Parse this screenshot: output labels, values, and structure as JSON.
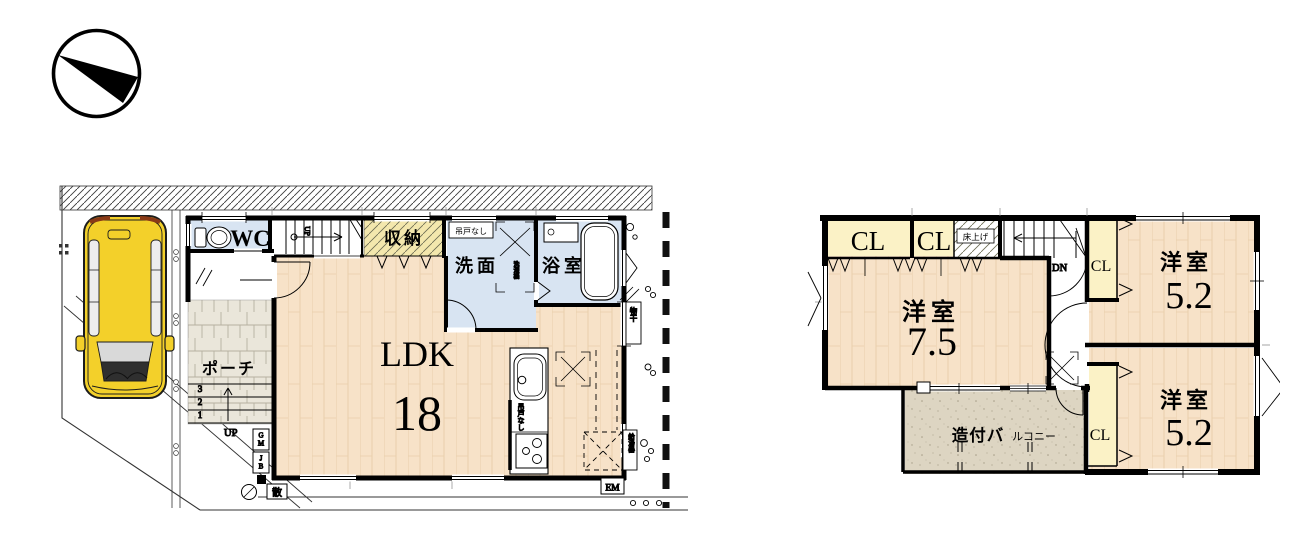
{
  "floor1": {
    "wc": "WC",
    "storage": "収納",
    "no_hanging_door": "吊戸なし",
    "washroom": "洗面",
    "bathroom": "浴室",
    "washer": "洗濯機",
    "ldk": "LDK",
    "ldk_size": "18",
    "porch": "ポーチ",
    "kitchen_no_hanging_door": "吊戸なし",
    "up_stairs": "UP",
    "up_entry": "UP",
    "step1": "1",
    "step2": "2",
    "step3": "3",
    "gm": "GM",
    "jb": "JB",
    "sprinkler": "散",
    "em": "EM",
    "laundry_pole": "物干",
    "water_heater": "給湯器"
  },
  "floor2": {
    "cl1": "CL",
    "cl2": "CL",
    "cl3": "CL",
    "cl4": "CL",
    "raised_floor": "床上げ",
    "dn": "DN",
    "bedroom_main": "洋室",
    "bedroom_main_size": "7.5",
    "bedroom_2": "洋室",
    "bedroom_2_size": "5.2",
    "bedroom_3": "洋室",
    "bedroom_3_size": "5.2",
    "balcony": "造付バ",
    "balcony_small": "ルコニー"
  },
  "colors": {
    "wall": "#000000",
    "wood_floor": "#f7e2c8",
    "wet_room": "#d8e4f2",
    "closet": "#fbf2c6",
    "storage_fill": "#f3e7ad",
    "balcony_fill": "#ddd5c2",
    "porch_fill": "#eae6da",
    "car_body": "#f3d02a"
  }
}
